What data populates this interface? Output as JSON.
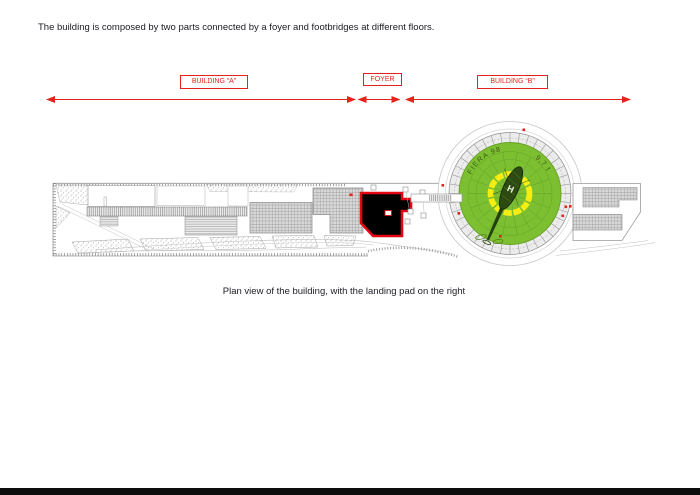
{
  "document": {
    "intro_text": "The building is composed by two parts connected by a foyer and footbridges at different floors.",
    "caption": "Plan view of the building, with the landing pad on the right"
  },
  "labels": {
    "building_a": "BUILDING “A”",
    "foyer": "FOYER",
    "building_b": "BUILDING “B”"
  },
  "landing_pad": {
    "arc_text_left": "FIERA 98",
    "arc_text_right": "9,7 t",
    "helipad_letter": "H"
  },
  "colors": {
    "dimension_red": "#e5231b",
    "foyer_outline": "#e30613",
    "foyer_fill": "#000000",
    "pad_green": "#7cbf31",
    "pad_yellow": "#f6ee12"
  }
}
